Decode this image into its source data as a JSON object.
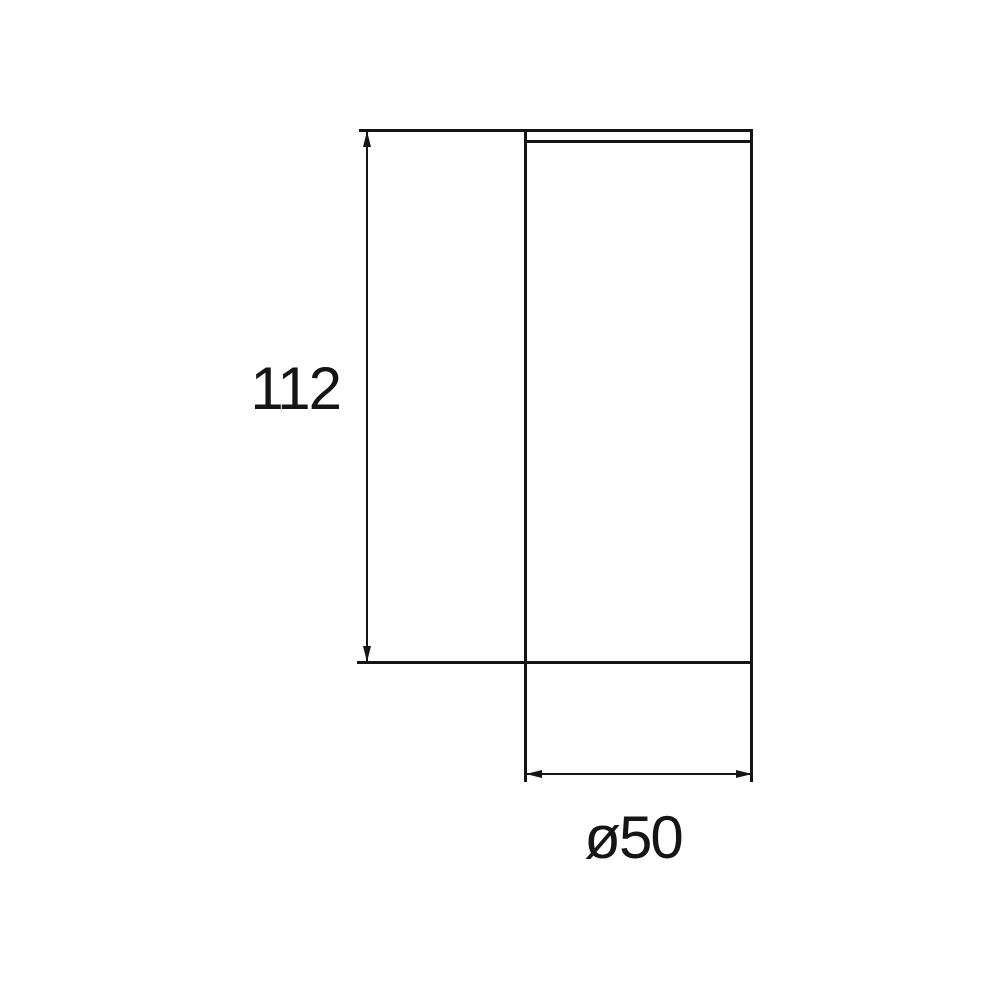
{
  "drawing": {
    "type": "technical-dimension-drawing",
    "subject": "cylinder-side-view",
    "dimensions": [
      {
        "name": "height",
        "label": "112"
      },
      {
        "name": "diameter",
        "label": "ø50"
      }
    ],
    "colors": {
      "line": "#151515",
      "background": "#ffffff"
    }
  }
}
